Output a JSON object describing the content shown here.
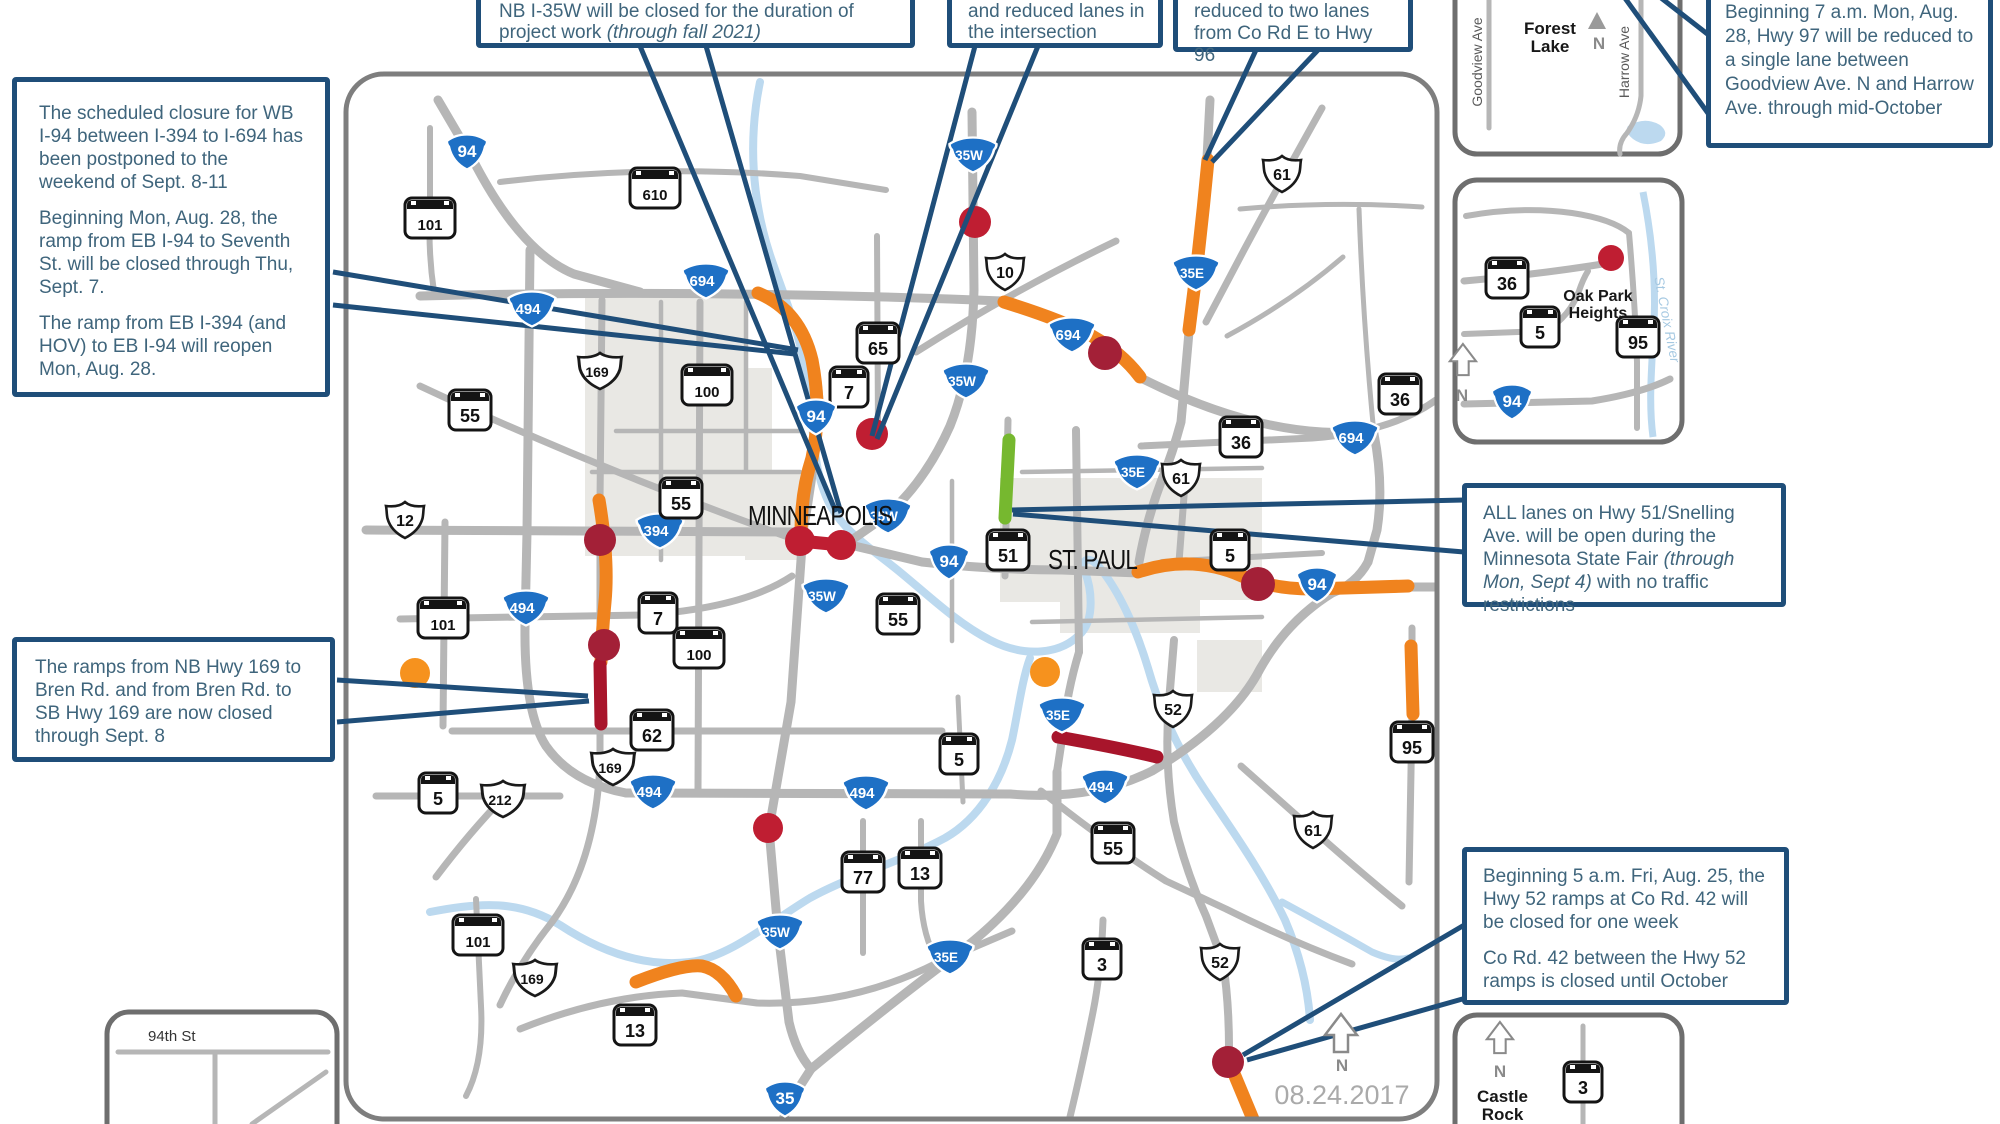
{
  "date": "08.24.2017",
  "compass": {
    "n": "N"
  },
  "cities": {
    "minneapolis": "MINNEAPOLIS",
    "st_paul": "ST. PAUL"
  },
  "callouts": {
    "c1": {
      "p1": "The scheduled closure for WB I-94 between I-394 to I-694 has been postponed to the weekend of Sept. 8-11",
      "p2": "Beginning Mon, Aug. 28, the ramp from EB I-94 to Seventh St. will be closed through Thu, Sept. 7.",
      "p3": "The ramp from EB I-394 (and HOV) to EB I-94 will reopen Mon, Aug. 28."
    },
    "c2": {
      "pre": "NB I-35W will be closed for the duration of project work ",
      "italic": "(through fall 2021)"
    },
    "c3": {
      "text": "and reduced lanes in the intersection"
    },
    "c4": {
      "text": "reduced to two lanes from Co Rd E to Hwy 96"
    },
    "c5": {
      "text": "Beginning 7 a.m. Mon, Aug. 28, Hwy 97 will be reduced to a single lane between Goodview Ave. N and Harrow Ave. through mid-October"
    },
    "c6": {
      "pre": "ALL lanes on Hwy 51/Snelling Ave. will be open during the Minnesota State Fair ",
      "italic": "(through Mon, Sept 4)",
      "post": " with no traffic restrictions"
    },
    "c7": {
      "text": "The ramps from NB Hwy 169 to Bren Rd. and from Bren Rd. to SB Hwy 169 are now closed through Sept. 8"
    },
    "c8": {
      "p1": "Beginning 5 a.m. Fri, Aug. 25, the Hwy 52 ramps at Co Rd. 42 will be closed for one week",
      "p2": "Co Rd. 42 between the Hwy 52 ramps is closed until October"
    }
  },
  "insets": {
    "forest_lake": {
      "title": "Forest Lake",
      "road1": "Goodview Ave",
      "road2": "Harrow Ave"
    },
    "oak_park": {
      "title": "Oak Park Heights",
      "river": "St. Croix River"
    },
    "ninety_fourth": {
      "title": "94th St"
    },
    "castle_rock": {
      "title": "Castle Rock"
    }
  },
  "colors": {
    "callout_border": "#1f4e79",
    "callout_text": "#3f657c",
    "road": "#b6b6b6",
    "map_border": "#7e7e7e",
    "urban": "#e9e8e4",
    "river": "#bcd9ef",
    "orange": "#f0831e",
    "maroon": "#a8152b",
    "red": "#bf1e32",
    "darkred": "#a32037",
    "green": "#76b82f",
    "interstate_blue": "#1e70c5",
    "orange_dot": "#f6921e"
  },
  "map": {
    "shields": [
      {
        "t": "i",
        "l": "94",
        "x": 467,
        "y": 152
      },
      {
        "t": "m",
        "l": "610",
        "x": 655,
        "y": 188
      },
      {
        "t": "m",
        "l": "101",
        "x": 430,
        "y": 218
      },
      {
        "t": "i",
        "l": "694",
        "x": 706,
        "y": 281
      },
      {
        "t": "i",
        "l": "494",
        "x": 532,
        "y": 309
      },
      {
        "t": "u",
        "l": "169",
        "x": 600,
        "y": 371
      },
      {
        "t": "m",
        "l": "100",
        "x": 707,
        "y": 385
      },
      {
        "t": "m",
        "l": "55",
        "x": 470,
        "y": 410
      },
      {
        "t": "m",
        "l": "7",
        "x": 849,
        "y": 387
      },
      {
        "t": "m",
        "l": "65",
        "x": 878,
        "y": 343
      },
      {
        "t": "i",
        "l": "35W",
        "x": 973,
        "y": 155
      },
      {
        "t": "u",
        "l": "10",
        "x": 1005,
        "y": 272
      },
      {
        "t": "i",
        "l": "694",
        "x": 1072,
        "y": 335
      },
      {
        "t": "i",
        "l": "35E",
        "x": 1196,
        "y": 273
      },
      {
        "t": "u",
        "l": "61",
        "x": 1282,
        "y": 174
      },
      {
        "t": "i",
        "l": "35W",
        "x": 966,
        "y": 381
      },
      {
        "t": "i",
        "l": "94",
        "x": 816,
        "y": 417
      },
      {
        "t": "i",
        "l": "394",
        "x": 660,
        "y": 531
      },
      {
        "t": "m",
        "l": "55",
        "x": 681,
        "y": 498
      },
      {
        "t": "u",
        "l": "12",
        "x": 405,
        "y": 520
      },
      {
        "t": "i",
        "l": "494",
        "x": 526,
        "y": 608
      },
      {
        "t": "m",
        "l": "101",
        "x": 443,
        "y": 618
      },
      {
        "t": "m",
        "l": "7",
        "x": 658,
        "y": 613
      },
      {
        "t": "m",
        "l": "100",
        "x": 699,
        "y": 648
      },
      {
        "t": "m",
        "l": "62",
        "x": 652,
        "y": 730
      },
      {
        "t": "u",
        "l": "169",
        "x": 613,
        "y": 767
      },
      {
        "t": "m",
        "l": "5",
        "x": 438,
        "y": 793
      },
      {
        "t": "u",
        "l": "212",
        "x": 503,
        "y": 799
      },
      {
        "t": "i",
        "l": "494",
        "x": 653,
        "y": 792
      },
      {
        "t": "i",
        "l": "35W",
        "x": 888,
        "y": 516
      },
      {
        "t": "i",
        "l": "35W",
        "x": 826,
        "y": 596
      },
      {
        "t": "i",
        "l": "94",
        "x": 949,
        "y": 562
      },
      {
        "t": "m",
        "l": "55",
        "x": 898,
        "y": 614
      },
      {
        "t": "m",
        "l": "51",
        "x": 1008,
        "y": 550
      },
      {
        "t": "m",
        "l": "5",
        "x": 1230,
        "y": 550
      },
      {
        "t": "i",
        "l": "35E",
        "x": 1137,
        "y": 472
      },
      {
        "t": "u",
        "l": "61",
        "x": 1181,
        "y": 478
      },
      {
        "t": "m",
        "l": "36",
        "x": 1241,
        "y": 437
      },
      {
        "t": "m",
        "l": "36",
        "x": 1400,
        "y": 394
      },
      {
        "t": "i",
        "l": "694",
        "x": 1355,
        "y": 438
      },
      {
        "t": "i",
        "l": "94",
        "x": 1317,
        "y": 585
      },
      {
        "t": "i",
        "l": "494",
        "x": 866,
        "y": 793
      },
      {
        "t": "m",
        "l": "5",
        "x": 959,
        "y": 754
      },
      {
        "t": "i",
        "l": "35E",
        "x": 1062,
        "y": 715
      },
      {
        "t": "u",
        "l": "52",
        "x": 1173,
        "y": 709
      },
      {
        "t": "i",
        "l": "494",
        "x": 1105,
        "y": 787
      },
      {
        "t": "m",
        "l": "95",
        "x": 1412,
        "y": 742
      },
      {
        "t": "m",
        "l": "55",
        "x": 1113,
        "y": 843
      },
      {
        "t": "u",
        "l": "61",
        "x": 1313,
        "y": 830
      },
      {
        "t": "m",
        "l": "77",
        "x": 863,
        "y": 872
      },
      {
        "t": "m",
        "l": "13",
        "x": 920,
        "y": 868
      },
      {
        "t": "m",
        "l": "101",
        "x": 478,
        "y": 935
      },
      {
        "t": "u",
        "l": "169",
        "x": 535,
        "y": 978
      },
      {
        "t": "m",
        "l": "13",
        "x": 635,
        "y": 1025
      },
      {
        "t": "i",
        "l": "35W",
        "x": 780,
        "y": 932
      },
      {
        "t": "i",
        "l": "35E",
        "x": 950,
        "y": 957
      },
      {
        "t": "i",
        "l": "35",
        "x": 785,
        "y": 1099
      },
      {
        "t": "m",
        "l": "3",
        "x": 1102,
        "y": 959
      },
      {
        "t": "u",
        "l": "52",
        "x": 1220,
        "y": 962
      },
      {
        "t": "m",
        "l": "36",
        "x": 1507,
        "y": 278
      },
      {
        "t": "m",
        "l": "5",
        "x": 1540,
        "y": 327
      },
      {
        "t": "m",
        "l": "95",
        "x": 1638,
        "y": 337
      },
      {
        "t": "i",
        "l": "94",
        "x": 1512,
        "y": 402
      },
      {
        "t": "m",
        "l": "3",
        "x": 1583,
        "y": 1082
      }
    ],
    "construction": [
      {
        "d": "M758,293 Q800,310 812,360 Q822,412 812,458 Q801,492 801,533",
        "c": "orange"
      },
      {
        "d": "M599,500 Q609,560 605,602 Q602,632 601,662",
        "c": "orange"
      },
      {
        "d": "M600,664 L601,724",
        "c": "maroon"
      },
      {
        "d": "M1208,160 Q1200,245 1189,330",
        "c": "orange"
      },
      {
        "d": "M1004,302 Q1062,320 1092,336 Q1122,353 1140,377",
        "c": "orange"
      },
      {
        "d": "M1138,572 Q1192,554 1242,576 Q1272,589 1312,589 L1408,586",
        "c": "orange"
      },
      {
        "d": "M1009,440 L1005,518",
        "c": "green"
      },
      {
        "d": "M800,541 L841,545",
        "c": "red"
      },
      {
        "d": "M1058,737 Q1120,748 1157,757",
        "c": "maroon"
      },
      {
        "d": "M636,982 Q682,964 702,966 Q722,970 736,996",
        "c": "orange"
      },
      {
        "d": "M1411,646 L1413,714",
        "c": "orange"
      },
      {
        "d": "M1230,1064 L1255,1124",
        "c": "orange"
      }
    ],
    "markers": [
      {
        "x": 975,
        "y": 222,
        "r": 16,
        "c": "red"
      },
      {
        "x": 1105,
        "y": 353,
        "r": 17,
        "c": "darkred"
      },
      {
        "x": 872,
        "y": 434,
        "r": 16,
        "c": "red"
      },
      {
        "x": 800,
        "y": 541,
        "r": 15,
        "c": "red"
      },
      {
        "x": 841,
        "y": 545,
        "r": 15,
        "c": "red"
      },
      {
        "x": 600,
        "y": 540,
        "r": 16,
        "c": "darkred"
      },
      {
        "x": 604,
        "y": 645,
        "r": 16,
        "c": "darkred"
      },
      {
        "x": 768,
        "y": 828,
        "r": 15,
        "c": "red"
      },
      {
        "x": 1258,
        "y": 584,
        "r": 17,
        "c": "darkred"
      },
      {
        "x": 415,
        "y": 673,
        "r": 15,
        "c": "orange_dot"
      },
      {
        "x": 1045,
        "y": 672,
        "r": 15,
        "c": "orange_dot"
      },
      {
        "x": 1228,
        "y": 1062,
        "r": 16,
        "c": "darkred"
      }
    ],
    "inset_markers": [
      {
        "x": 1611,
        "y": 258,
        "r": 13,
        "c": "red"
      }
    ]
  }
}
